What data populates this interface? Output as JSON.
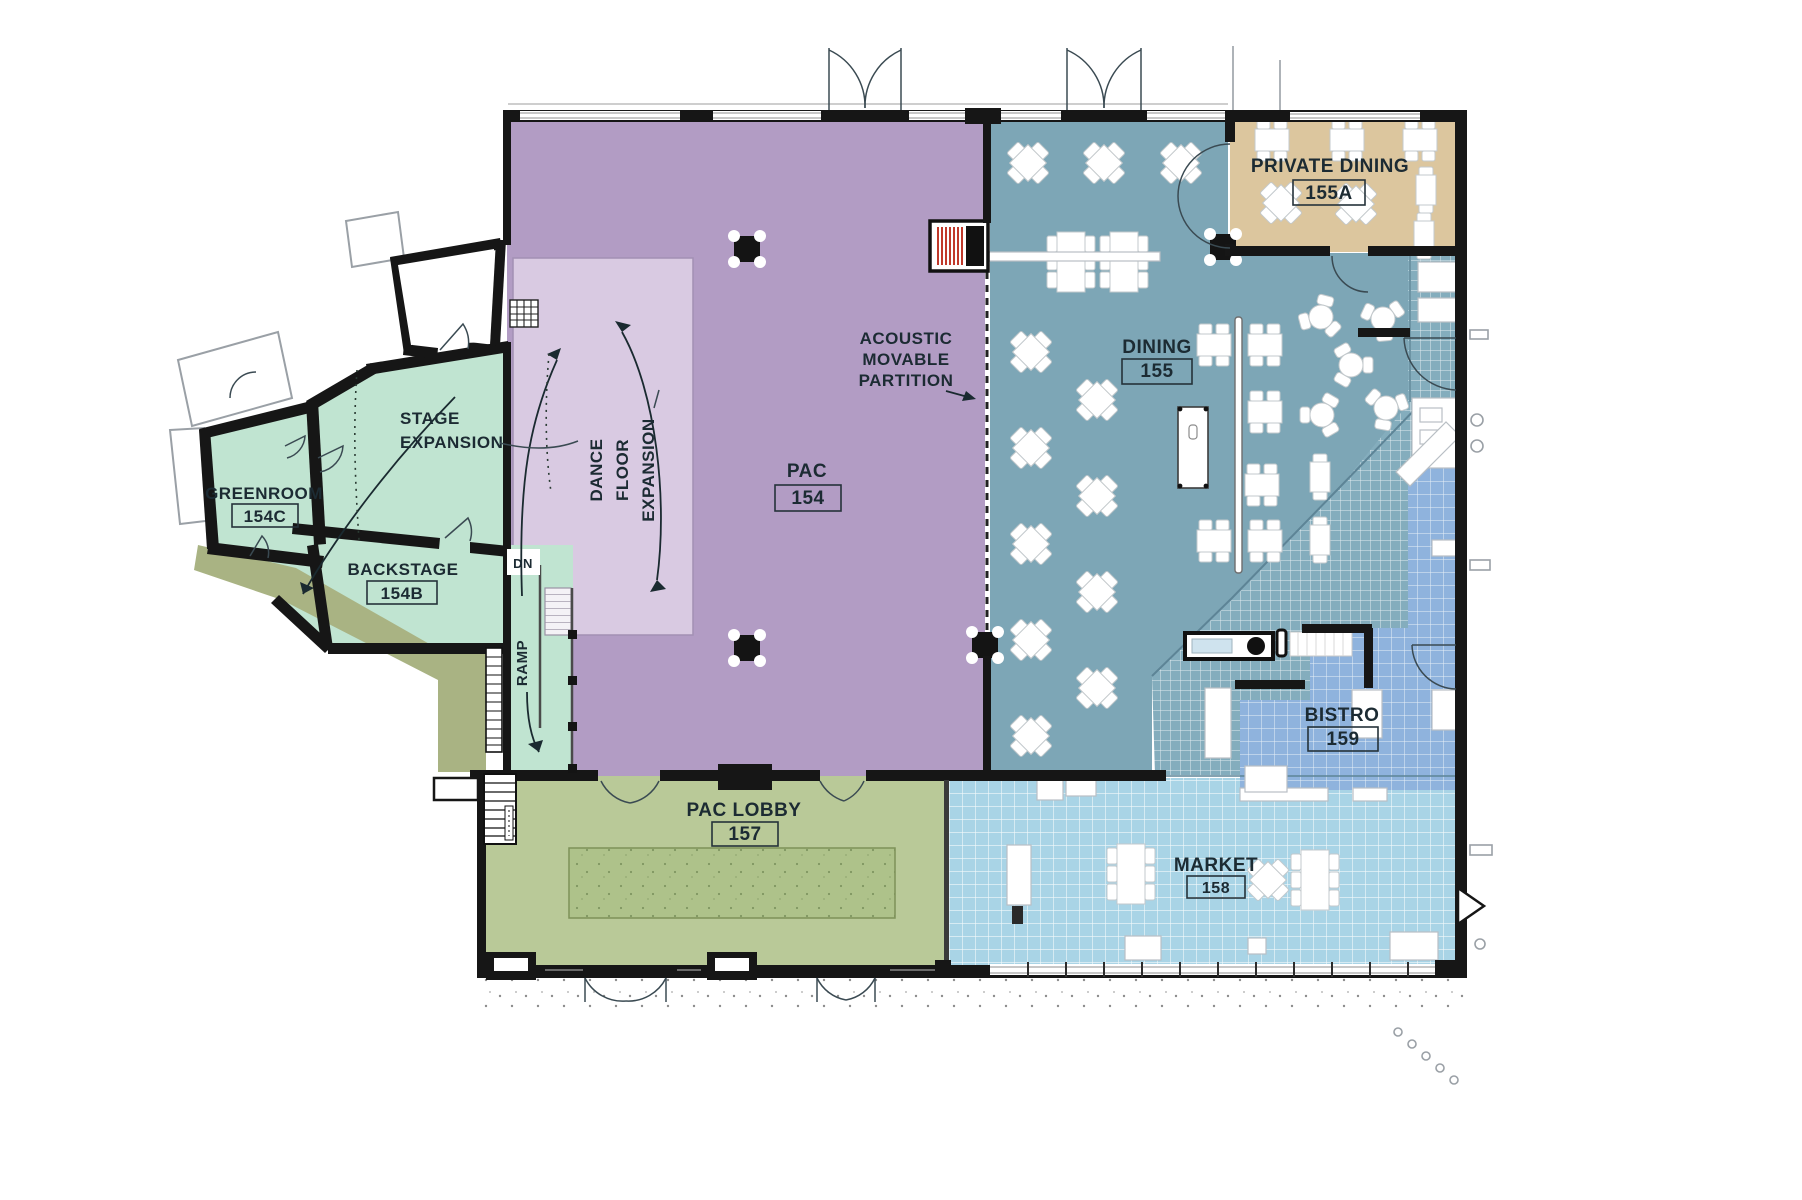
{
  "plan": {
    "rooms": {
      "pac": {
        "name": "PAC",
        "number": "154"
      },
      "pac_lobby": {
        "name": "PAC LOBBY",
        "number": "157"
      },
      "dining": {
        "name": "DINING",
        "number": "155"
      },
      "private_dining": {
        "name": "PRIVATE DINING",
        "number": "155A"
      },
      "market": {
        "name": "MARKET",
        "number": "158"
      },
      "bistro": {
        "name": "BISTRO",
        "number": "159"
      },
      "backstage": {
        "name": "BACKSTAGE",
        "number": "154B"
      },
      "greenroom": {
        "name": "GREENROOM",
        "number": "154C"
      }
    },
    "annotations": {
      "stage": [
        "STAGE",
        "EXPANSION"
      ],
      "dance": [
        "DANCE",
        "FLOOR",
        "EXPANSION"
      ],
      "acoustic": [
        "ACOUSTIC",
        "MOVABLE",
        "PARTITION"
      ],
      "ramp": "RAMP",
      "dn": "DN"
    },
    "colors": {
      "pac": "#b29cc4",
      "dance_floor": "#d9cae2",
      "mint": "#c0e4d1",
      "lobby": "#b9c998",
      "carpet": "#aec28a",
      "dining": "#7da6b6",
      "private_dining": "#dcc69e",
      "market": "#a9d4e6",
      "bistro": "#8fb3dd",
      "servery": "#84adbd",
      "olive": "#a9b383",
      "wall": "#161616",
      "label": "#1c2b33",
      "partition_hatch": "#c0392b"
    }
  }
}
